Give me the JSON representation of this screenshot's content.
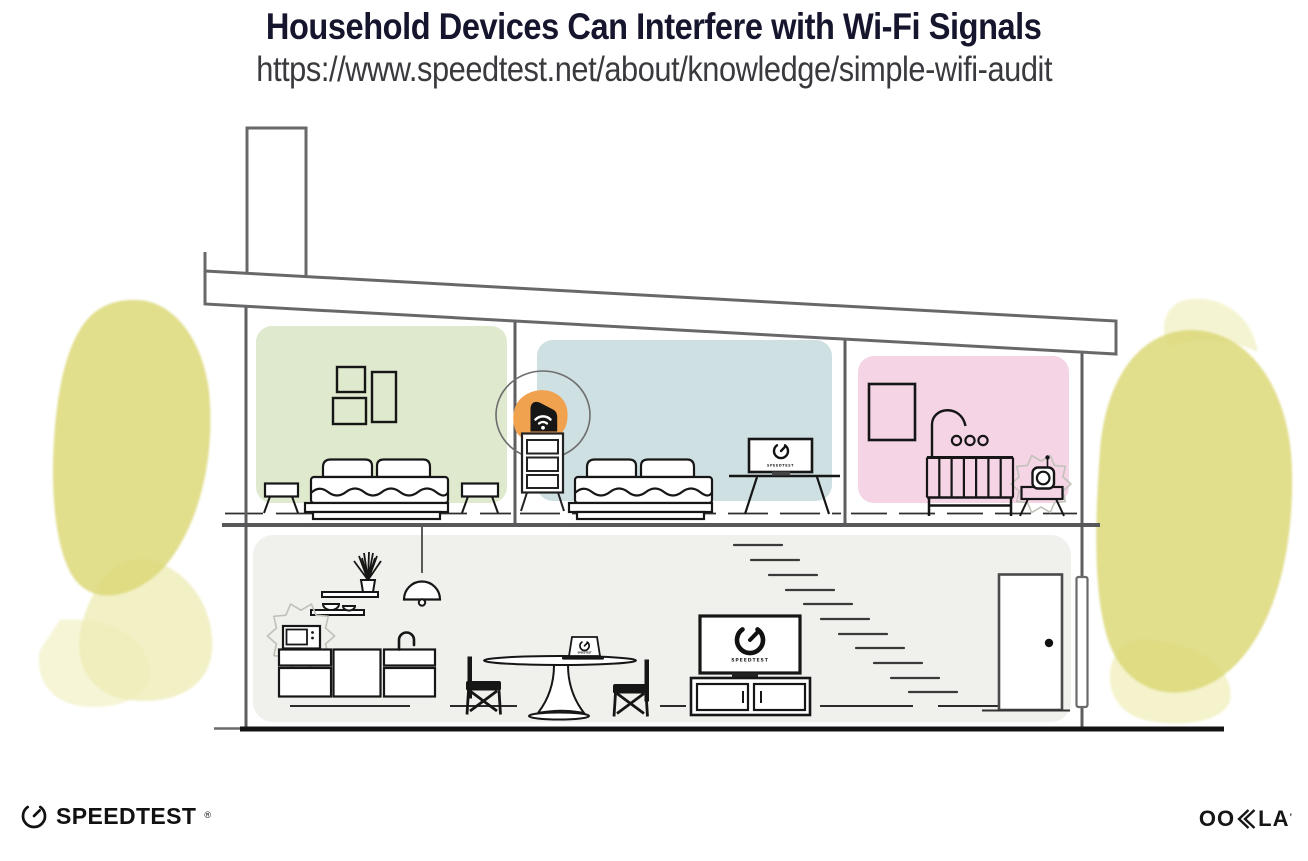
{
  "header": {
    "title": "Household Devices Can Interfere with Wi-Fi Signals",
    "url": "https://www.speedtest.net/about/knowledge/simple-wifi-audit"
  },
  "screens": {
    "label": "SPEEDTEST"
  },
  "footer": {
    "speedtest": "SPEEDTEST",
    "speedtest_mark": "®",
    "ookla_oo": "OO",
    "ookla_la": "LA",
    "ookla_mark": "’"
  },
  "colors": {
    "title_ink": "#15152D",
    "text_ink": "#3A3A3E",
    "line_gray": "#5E5E60",
    "device_ink": "#161616",
    "accent_orange": "#F1A24E",
    "room_green": "#DEE9CE",
    "room_blue": "#CFE0E2",
    "room_pink": "#F5D4E6",
    "room_gray": "#F0F0ED",
    "tree_yellow": "#DCD878"
  }
}
